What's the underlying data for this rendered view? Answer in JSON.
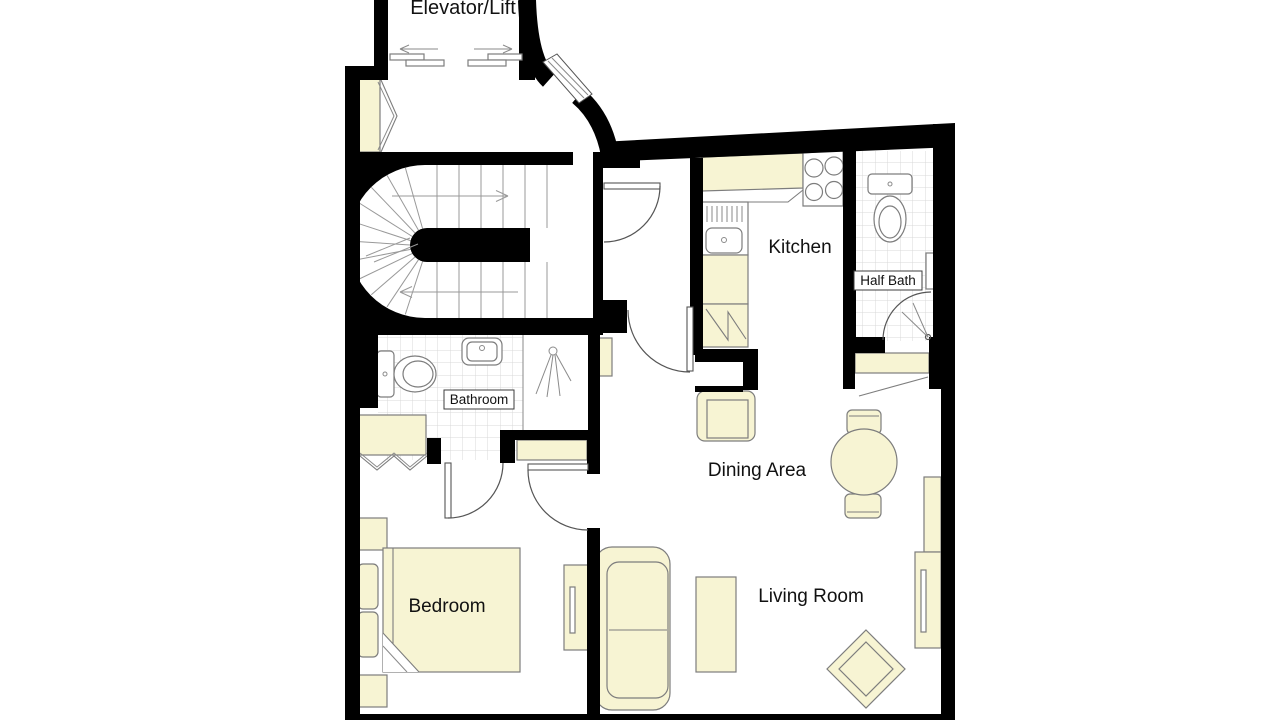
{
  "floorplan": {
    "rooms": {
      "elevator": "Elevator/Lift",
      "kitchen": "Kitchen",
      "half_bath": "Half Bath",
      "bathroom": "Bathroom",
      "dining": "Dining Area",
      "living": "Living Room",
      "bedroom": "Bedroom"
    },
    "colors": {
      "wall": "#000000",
      "furniture": "#F7F4D3",
      "outline": "#7d7d7d",
      "tile": "#d8d8d8",
      "text": "#111111",
      "background": "#ffffff"
    }
  }
}
